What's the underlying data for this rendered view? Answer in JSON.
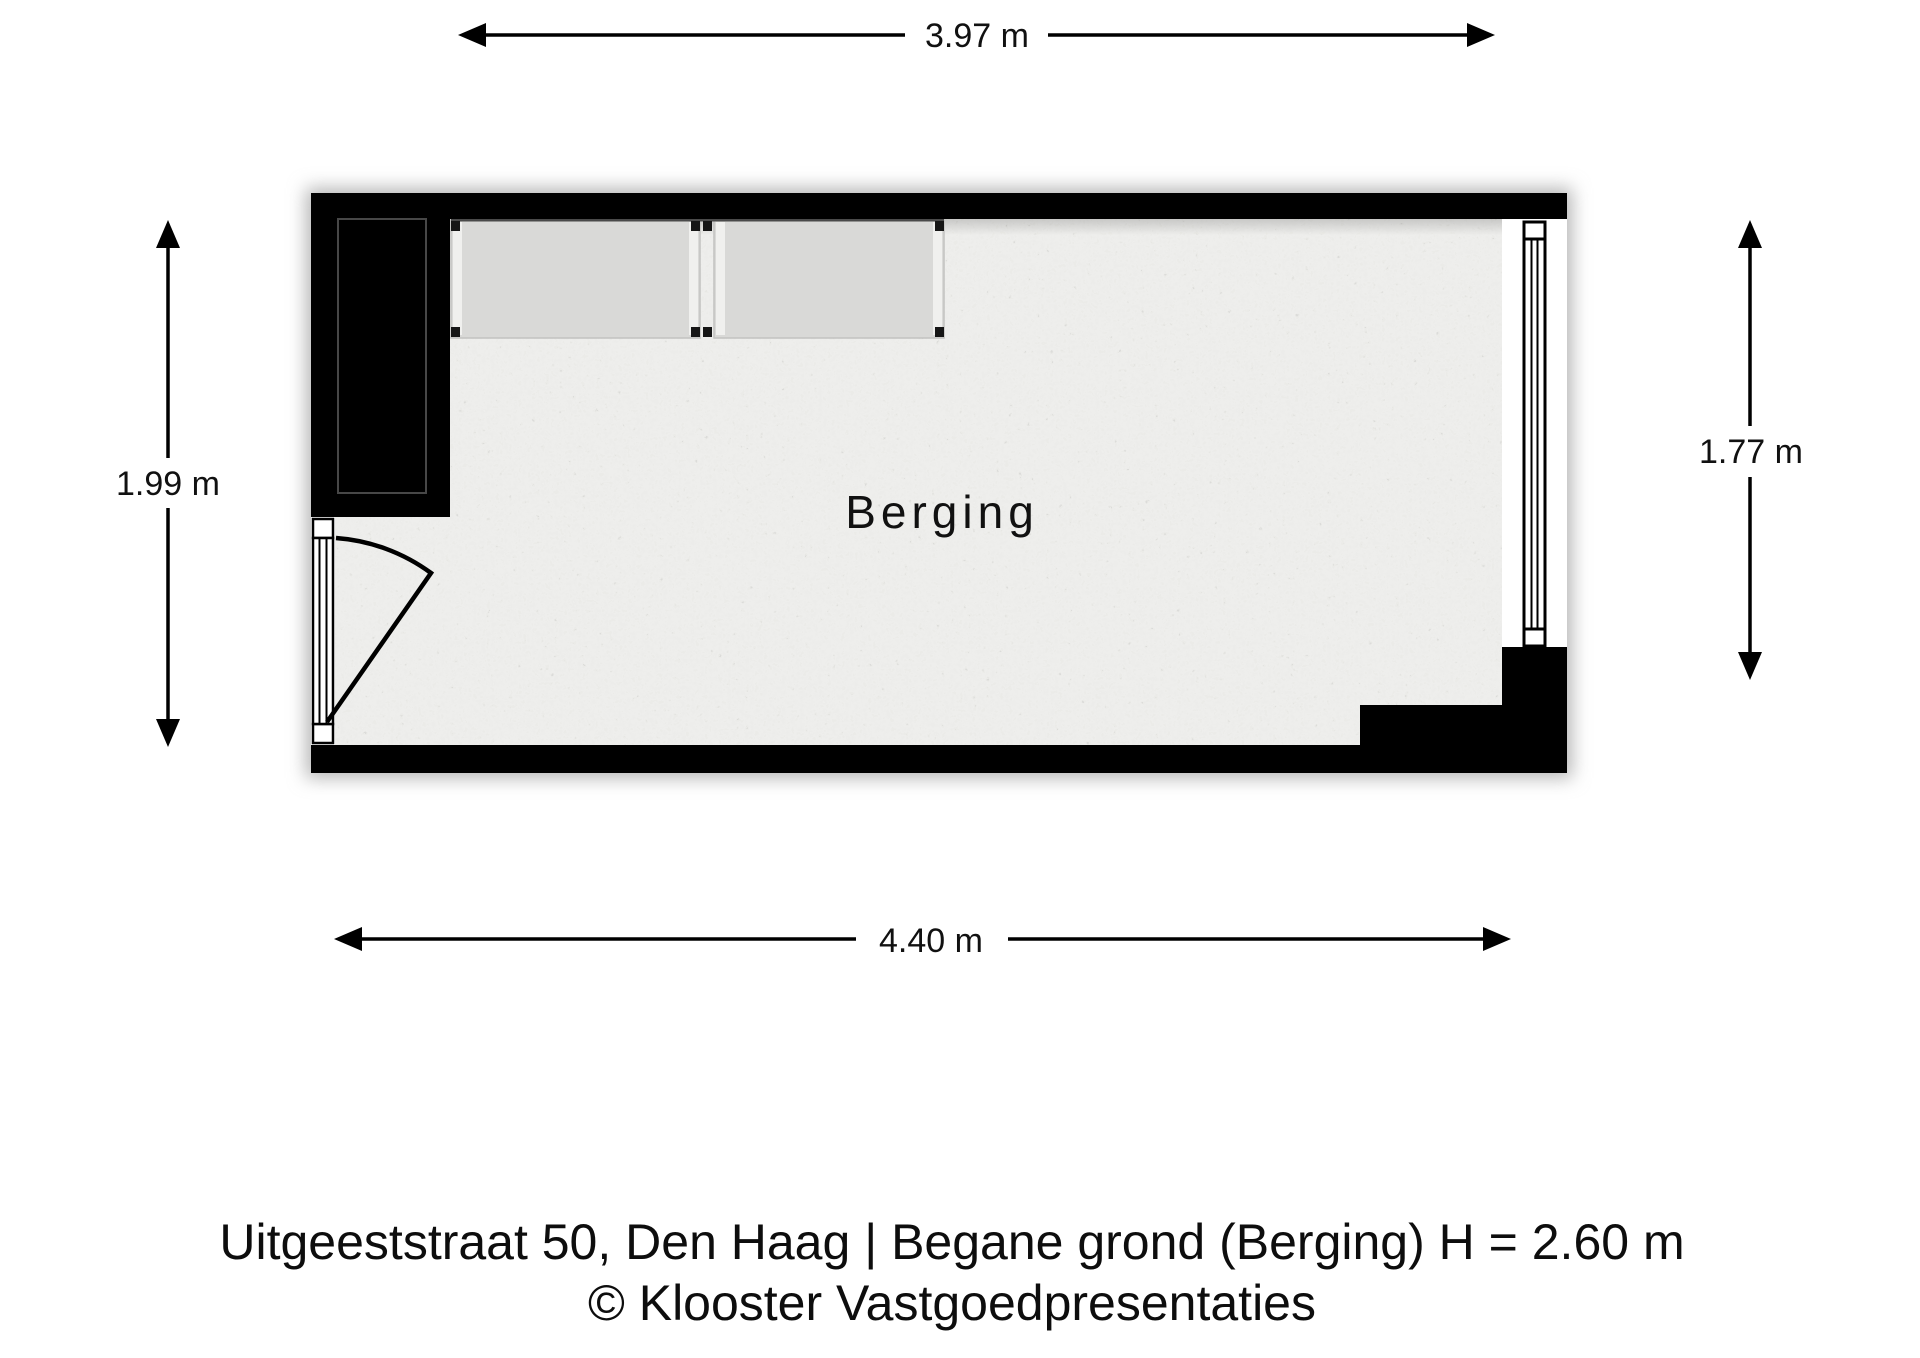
{
  "floorplan": {
    "room_label": "Berging",
    "dimensions": {
      "top": "3.97 m",
      "bottom": "4.40 m",
      "left": "1.99 m",
      "right": "1.77 m"
    },
    "caption_line1": "Uitgeeststraat 50, Den Haag | Begane grond (Berging) H = 2.60 m",
    "caption_line2": "© Klooster Vastgoedpresentaties",
    "colors": {
      "wall": "#000000",
      "floor_base": "#d8d7d3",
      "cabinet": "#d9d9d7",
      "opening": "#ffffff",
      "text": "#111111"
    }
  }
}
